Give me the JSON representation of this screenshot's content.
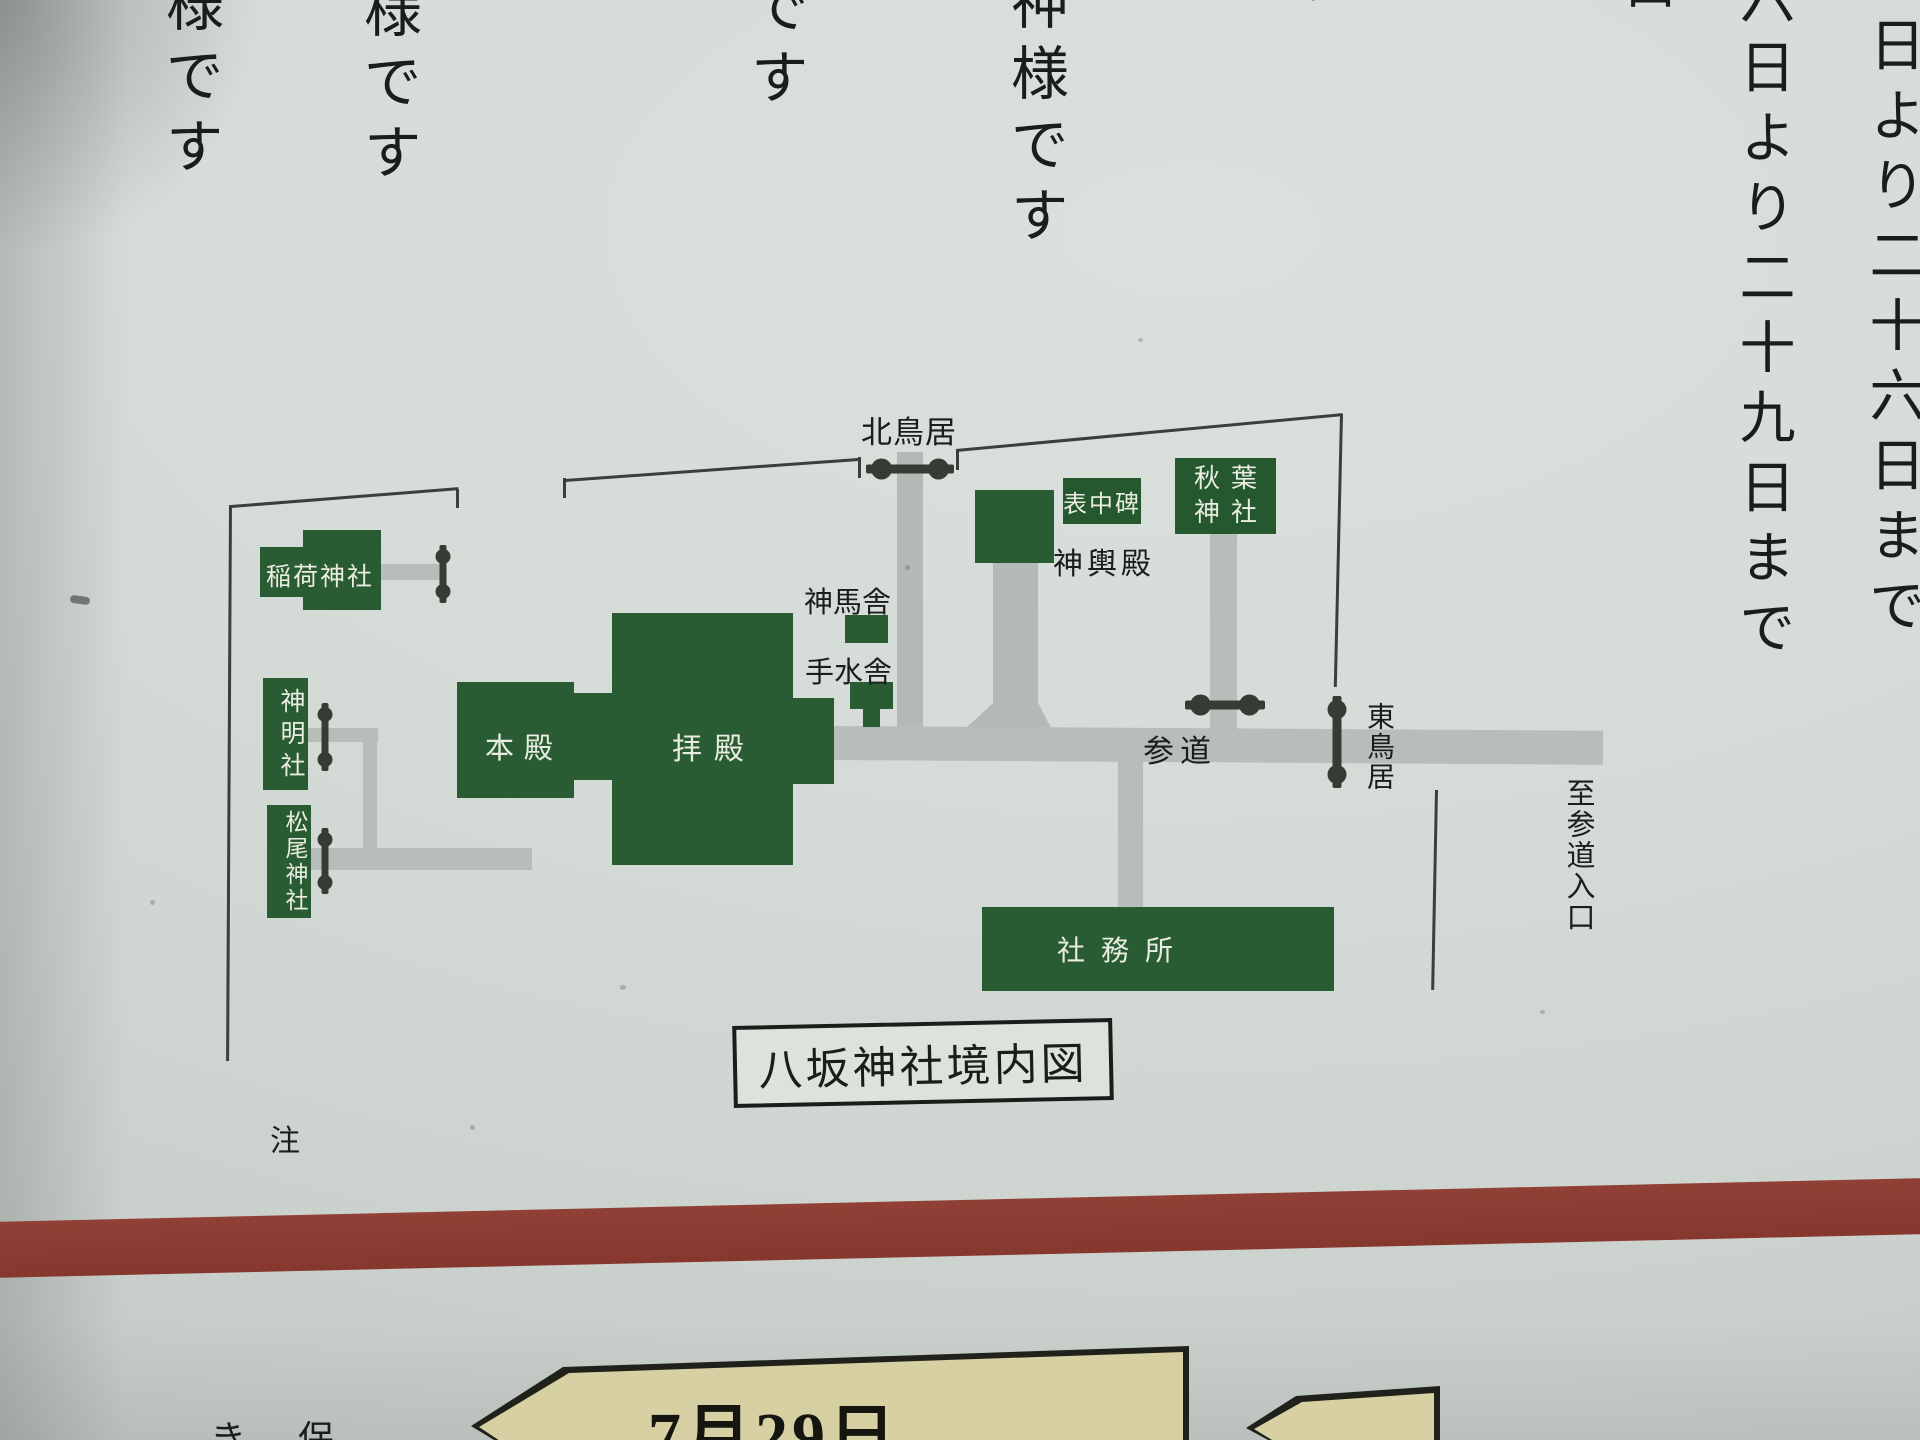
{
  "top_text": {
    "left_col_1": "様です",
    "left_col_2": "様です",
    "left_col_3": "です",
    "left_col_4": "神様です",
    "fragment_su": "す",
    "fragment_kuchi": "口",
    "right_col_inner": "六日より二十九日まで",
    "right_col_outer": "日より二十六日まで"
  },
  "map": {
    "title": "八坂神社境内図",
    "buildings": {
      "inari": "稲荷神社",
      "shinmei": "神明社",
      "matsuo": "松尾神社",
      "honden": "本殿",
      "haiden": "拝殿",
      "hyochuhi": "表中碑",
      "akiba_line1": "秋葉",
      "akiba_line2": "神社",
      "shamusho": "社務所"
    },
    "labels": {
      "north_torii": "北鳥居",
      "shinmesha": "神馬舎",
      "chozuya": "手水舎",
      "mikoshiden": "神輿殿",
      "sando": "参道",
      "east_torii": "東鳥居",
      "to_sando_entrance": "至参道入口"
    }
  },
  "bottom": {
    "note": "注",
    "date_banner": "7月29日",
    "partial_1": "き",
    "partial_2": "保"
  },
  "colors": {
    "building_green": "#2a5c33",
    "path_gray": "#b7bdb8",
    "line_ink": "#3a3f3b",
    "text_ink": "#1b1d1a",
    "red_bar": "#8c3a31",
    "banner_tan": "#d7d0a2",
    "paper": "#d3d9d5"
  }
}
